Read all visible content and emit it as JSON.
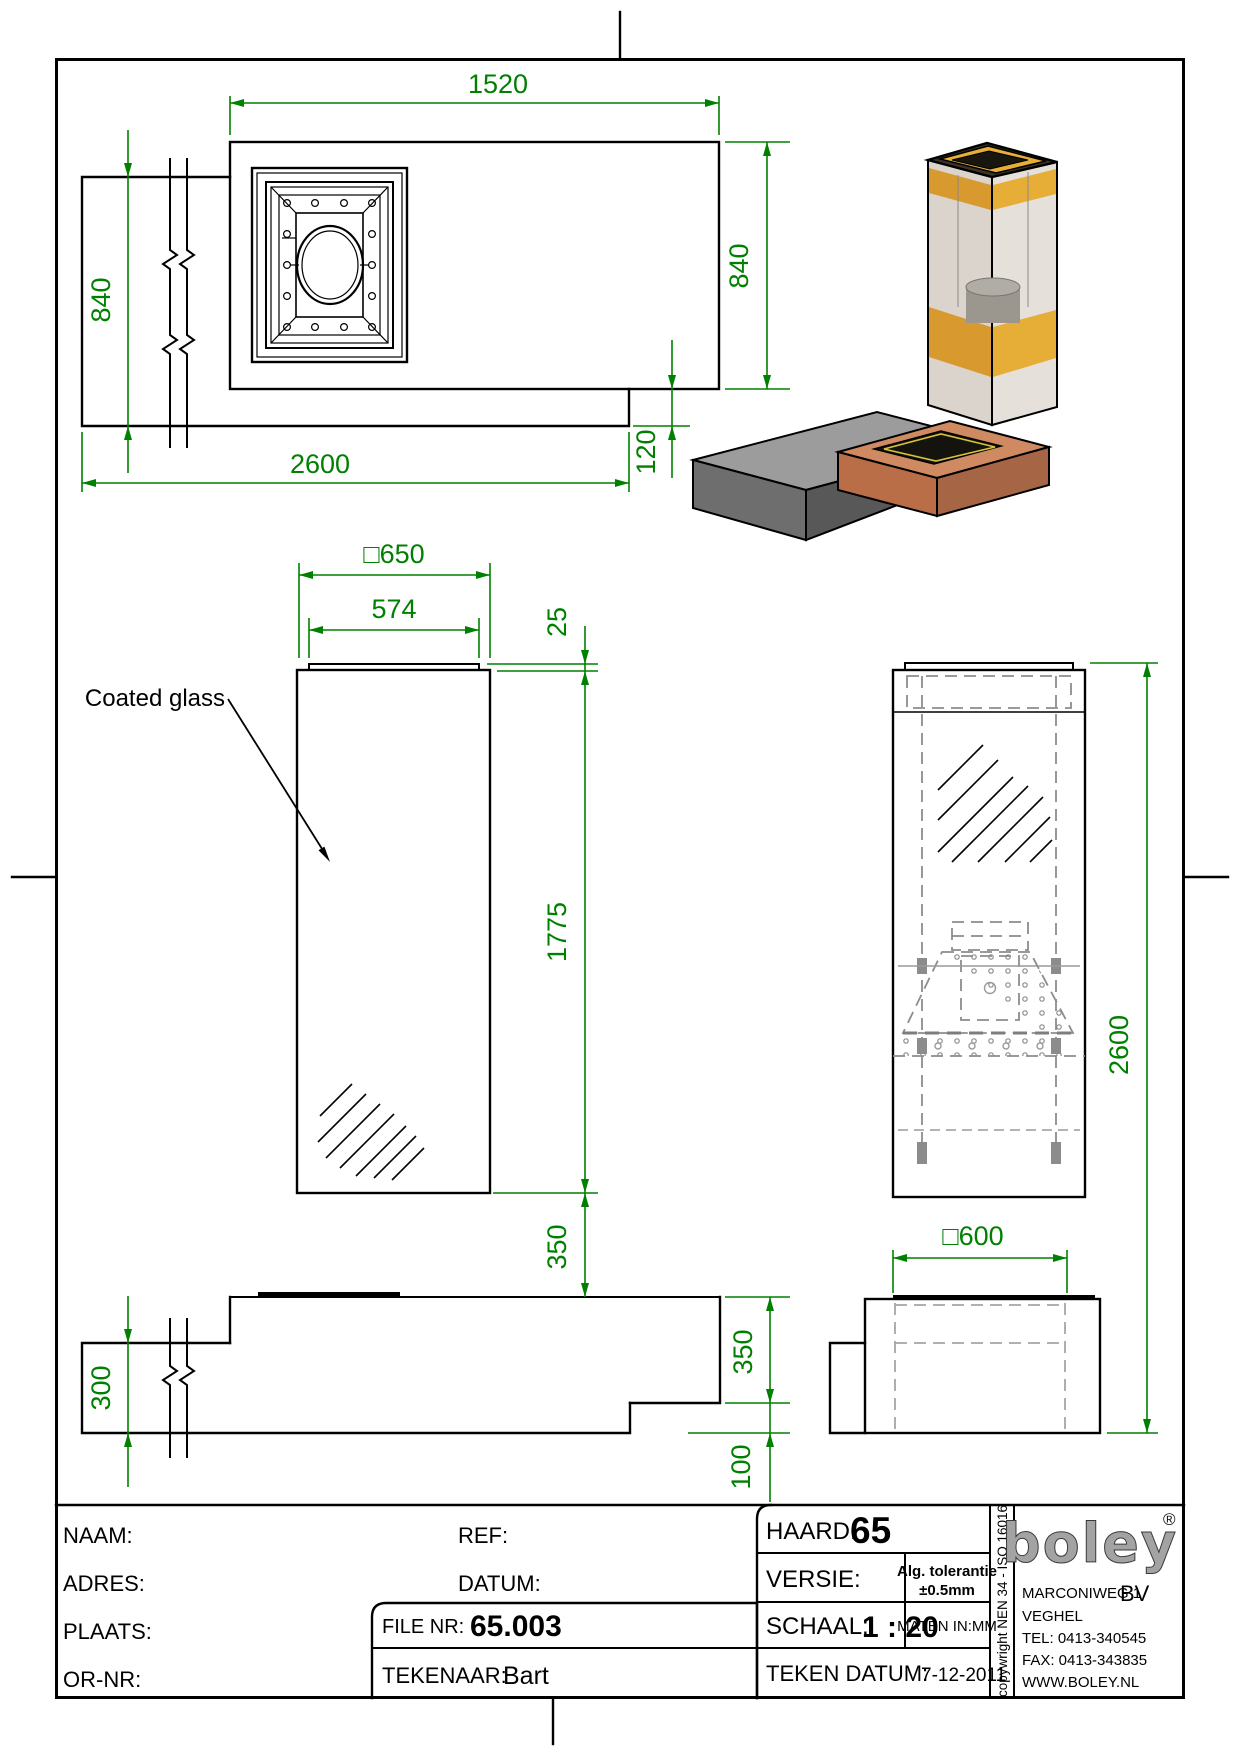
{
  "drawing": {
    "labels": {
      "coated_glass": "Coated glass"
    },
    "dims": {
      "plate_w": "1520",
      "plate_d": "840",
      "bench_d": "840",
      "bench_l": "2600",
      "overhang": "120",
      "glass_w": "□650",
      "collar_w": "574",
      "collar_h": "25",
      "glass_h": "1775",
      "gap": "350",
      "bench_h": "300",
      "unit_h": "350",
      "lip": "100",
      "box": "□600",
      "total_h": "2600"
    }
  },
  "title_block": {
    "naam_label": "NAAM:",
    "adres_label": "ADRES:",
    "plaats_label": "PLAATS:",
    "ornr_label": "OR-NR:",
    "ref_label": "REF:",
    "datum_label": "DATUM:",
    "file_label": "FILE NR:",
    "file_value": "65.003",
    "tekenaar_label": "TEKENAAR:",
    "tekenaar_value": "Bart",
    "haard_label": "HAARD:",
    "haard_value": "65",
    "versie_label": "VERSIE:",
    "tolerantie_line1": "Alg. tolerantie",
    "tolerantie_line2": "±0.5mm",
    "schaal_label": "SCHAAL:",
    "schaal_value": "1 : 20",
    "maten_label": "MATEN IN:MM",
    "teken_datum_label": "TEKEN DATUM:",
    "teken_datum_value": "7-12-2011",
    "copyright": "copywright NEN 34 - ISO 16016",
    "company": {
      "logo_text": "boley",
      "registered": "®",
      "address1": "MARCONIWEG 1",
      "bv": "BV",
      "address2": "VEGHEL",
      "tel": "TEL: 0413-340545",
      "fax": "FAX: 0413-343835",
      "web": "WWW.BOLEY.NL"
    }
  },
  "colors": {
    "dimension_green": "#008000",
    "line_black": "#000000",
    "hidden_gray": "#8c8c8c",
    "copper_top": "#cf8a62",
    "copper_front": "#b96e48",
    "copper_side": "#a66544",
    "bench_top": "#9c9c9c",
    "bench_front": "#6e6e6e",
    "glass_tint": "#b7ab9f",
    "burner_orange": "#d89a2e",
    "logo_gray": "#a3a3a3"
  }
}
